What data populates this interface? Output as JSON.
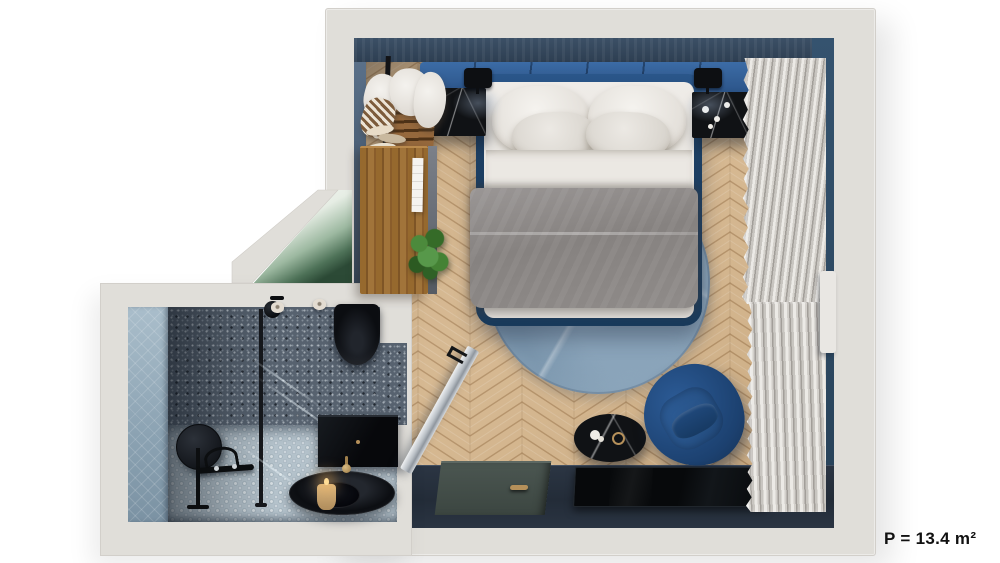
{
  "floor_plan": {
    "type": "3d-top-down-apartment-render",
    "area_label": "P = 13.4 m²",
    "rooms": [
      {
        "name": "bedroom",
        "furniture": [
          "double-bed",
          "gray-duvet",
          "pillows",
          "upholstered-headboard",
          "nightstand-left",
          "nightstand-right",
          "wall-sconce-left",
          "wall-sconce-right",
          "round-rug",
          "blue-armchair",
          "black-marble-side-table",
          "wall-tv",
          "curtains",
          "entry-door",
          "clothes-rack",
          "wardrobe",
          "potted-plant",
          "angled-glass-wall",
          "herringbone-floor"
        ]
      },
      {
        "name": "bathroom",
        "fixtures": [
          "walk-in-shower",
          "glass-partition",
          "shower-head",
          "wall-hung-toilet",
          "toilet-paper-rolls",
          "round-mirror",
          "valet-stand",
          "vanity-cabinet",
          "black-basin",
          "gold-faucet",
          "candle",
          "penny-tile-floor",
          "terrazzo-walls"
        ]
      }
    ]
  },
  "palette": {
    "page_bg": "#ffffff",
    "wall": "#e0ded9",
    "wall_edge": "#c9c6c1",
    "bedroom_wall_top": "#33465c",
    "bedroom_wall_left": "#4c6076",
    "right_wall": "#2e4c6b",
    "headboard": "#34649e",
    "floor_wood": "#d3b389",
    "floor_wood_line": "#b7925f",
    "bed_frame": "#1f4064",
    "mattress": "#eae7e2",
    "pillow": "#f1efeb",
    "duvet": "#8d8885",
    "rug": "#9db3c4",
    "armchair": "#1d4371",
    "marble_black": "#101215",
    "curtain_hi": "#eceae6",
    "curtain_lo": "#a29e99",
    "bottom_wall": "#27303d",
    "tv": "#08090b",
    "door": "#46514c",
    "gold": "#b5905a",
    "terrazzo": "#57626f",
    "bath_left": "#a2b6c3",
    "bath_floor": "#b4c2cb",
    "wood": "#8d5f36",
    "plant": "#3c7a2f",
    "glass_green": "#2f4f3a",
    "label": "#111111"
  }
}
